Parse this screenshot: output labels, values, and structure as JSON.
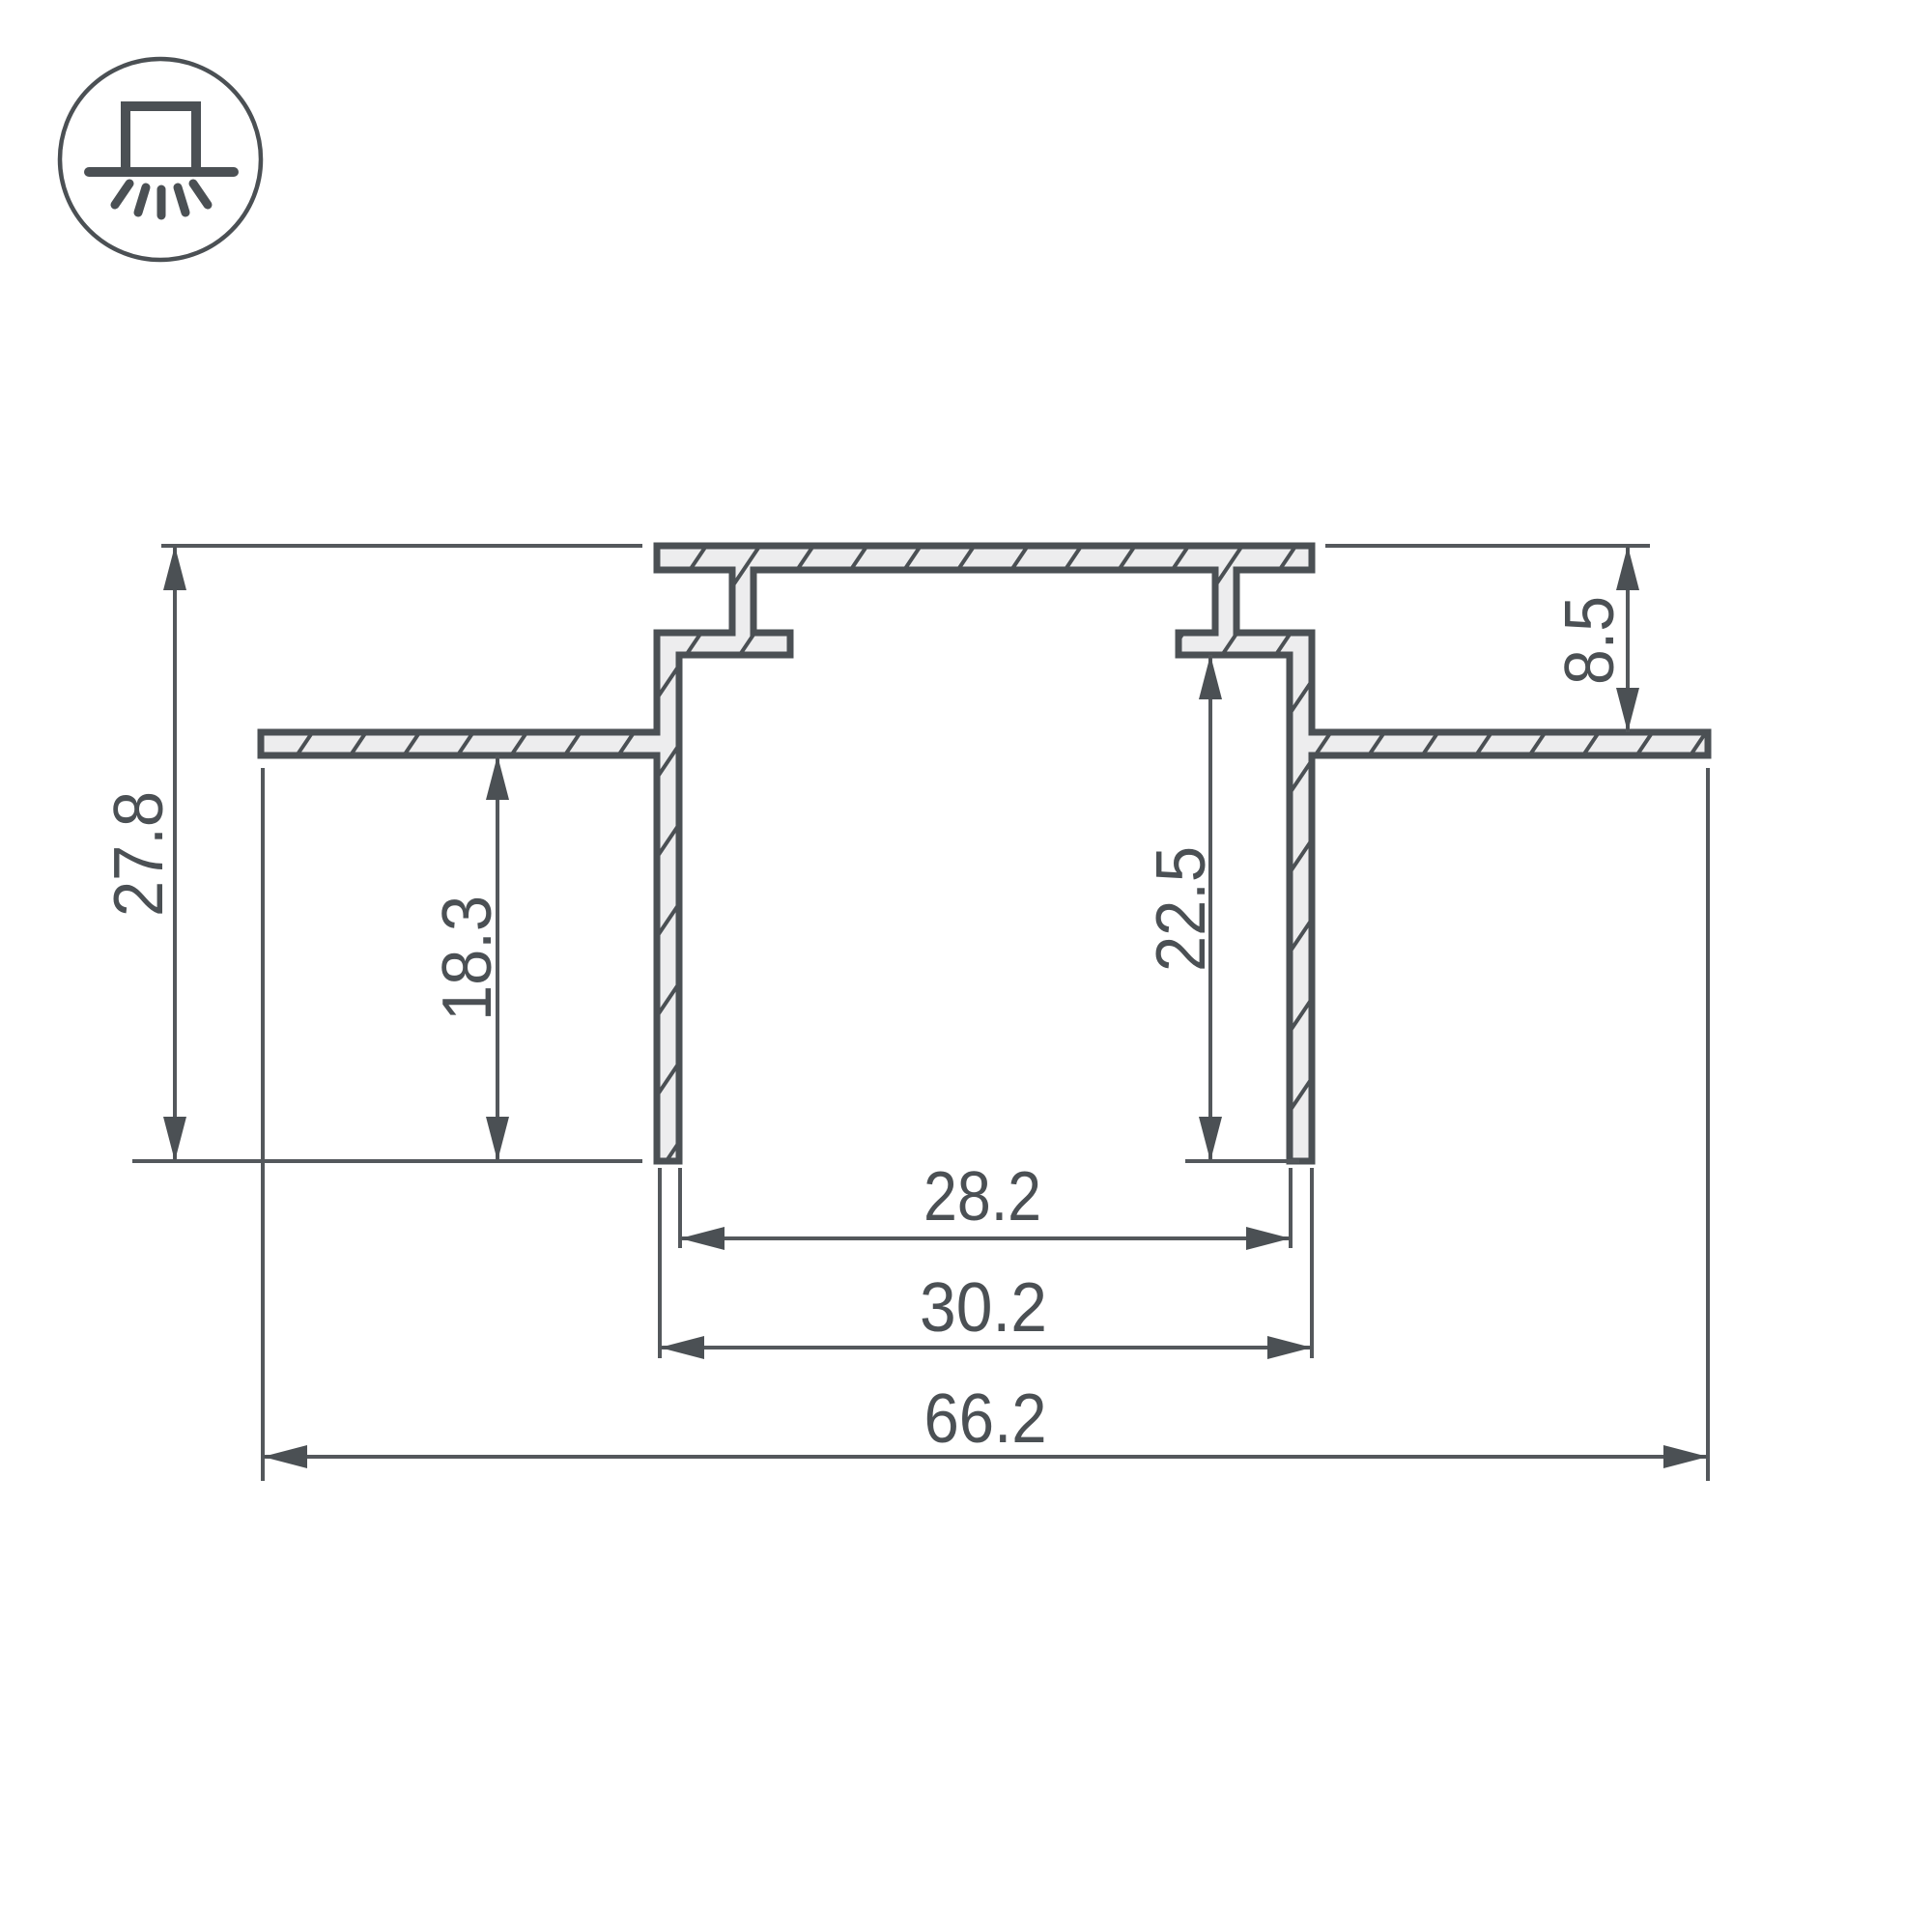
{
  "drawing": {
    "type": "profile-cross-section",
    "icon": "recessed-mount-light-icon",
    "colors": {
      "line": "#4b5054",
      "thin_line": "#54585c",
      "fill": "#ededee",
      "background": "#ffffff"
    },
    "dimensions": {
      "overall_height": {
        "value": "27.8",
        "orientation": "vertical-left"
      },
      "left_inner_depth": {
        "value": "18.3",
        "orientation": "vertical-left"
      },
      "flange_recess": {
        "value": "8.5",
        "orientation": "vertical-right"
      },
      "cavity_depth": {
        "value": "22.5",
        "orientation": "vertical-center"
      },
      "inner_width": {
        "value": "28.2",
        "orientation": "horizontal"
      },
      "outer_width": {
        "value": "30.2",
        "orientation": "horizontal"
      },
      "overall_width": {
        "value": "66.2",
        "orientation": "horizontal"
      }
    }
  }
}
